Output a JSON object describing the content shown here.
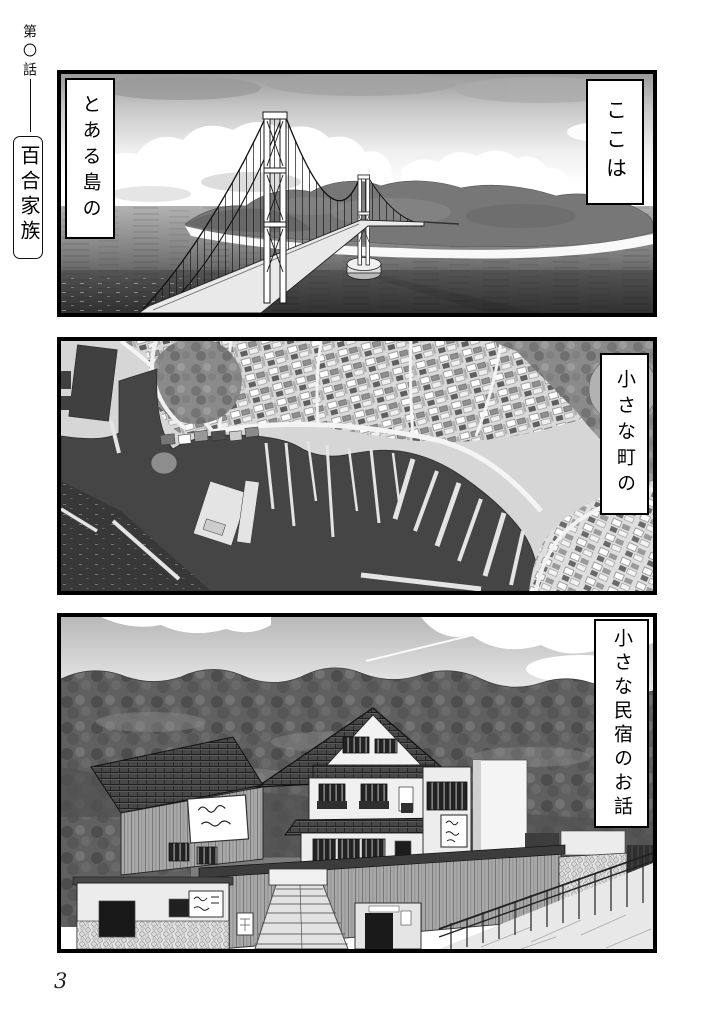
{
  "page": {
    "episode_label": "第〇話",
    "series_title": "百合家族",
    "page_number": "3"
  },
  "panels": [
    {
      "name": "island-bridge-scene",
      "captions": [
        {
          "text": "ここは"
        },
        {
          "text": "とある島の"
        }
      ]
    },
    {
      "name": "harbor-town-aerial-scene",
      "captions": [
        {
          "text": "小さな町の"
        }
      ]
    },
    {
      "name": "minshuku-inn-scene",
      "captions": [
        {
          "text": "小さな民宿のお話"
        }
      ]
    }
  ]
}
